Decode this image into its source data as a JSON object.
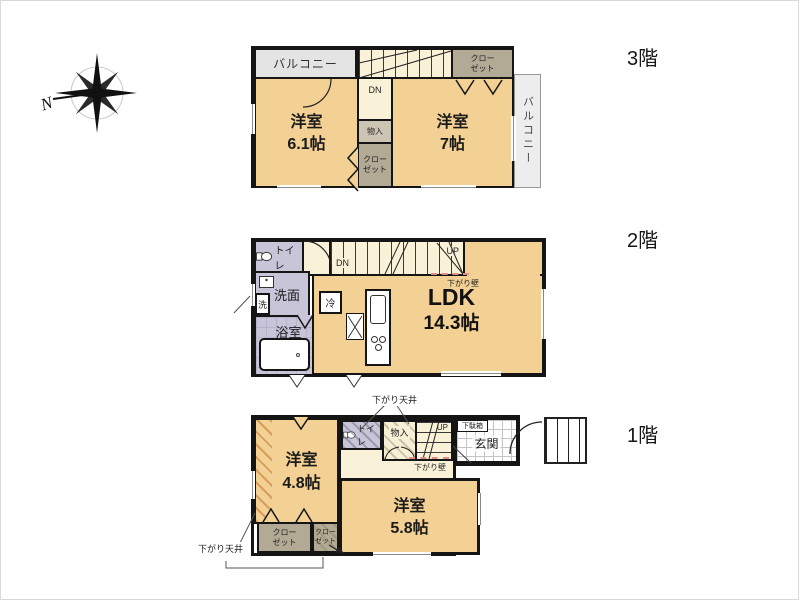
{
  "compass": {
    "north_label": "N"
  },
  "floor_titles": {
    "f3": "3階",
    "f2": "2階",
    "f1": "1階"
  },
  "f3": {
    "balcony_top": "バルコニー",
    "balcony_right": "バルコニー",
    "room_left_name": "洋室",
    "room_left_size": "6.1帖",
    "room_right_name": "洋室",
    "room_right_size": "7帖",
    "closet_topright": "クロー\nゼット",
    "closet_mid": "クロー\nゼット",
    "storage": "物入",
    "stairs_down": "DN"
  },
  "f2": {
    "toilet": "トイレ",
    "washroom": "洗面",
    "washer": "洗",
    "bathroom": "浴室",
    "fridge": "冷",
    "ldk_name": "LDK",
    "ldk_size": "14.3帖",
    "stairs_down": "DN",
    "stairs_up": "UP",
    "drop_wall": "下がり壁"
  },
  "f1": {
    "room_left_name": "洋室",
    "room_left_size": "4.8帖",
    "room_main_name": "洋室",
    "room_main_size": "5.8帖",
    "toilet": "トイレ",
    "storage": "物入",
    "stairs_up": "UP",
    "shoe_cabinet": "下駄箱",
    "entrance": "玄関",
    "closet_left": "クロー\nゼット",
    "closet_right": "クロー\nゼット",
    "drop_wall": "下がり壁",
    "drop_ceiling_top": "下がり天井",
    "drop_ceiling_left": "下がり天井"
  },
  "colors": {
    "room_tan": "#f3d093",
    "hall_cream": "#faf2d8",
    "closet_brown": "#b3aa96",
    "wet_area_lavender": "#c8c5d8",
    "balcony_gray": "#e4e4e4",
    "wall_black": "#1a1a1a",
    "drop_wall_pink": "#e08a8a",
    "entrance_tile": "#ffffff"
  }
}
